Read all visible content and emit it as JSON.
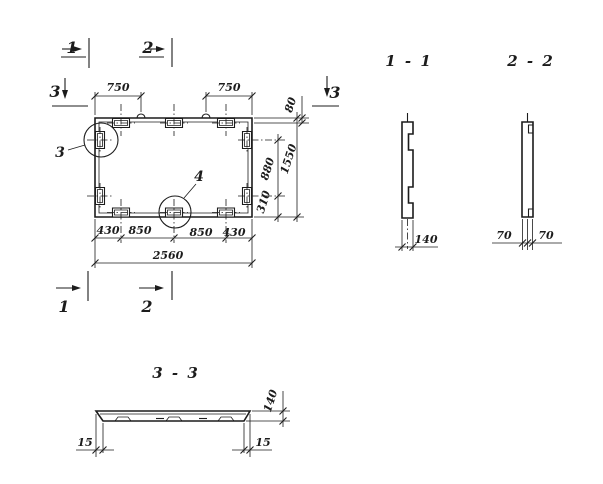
{
  "colors": {
    "ink": "#1c1c1c",
    "bg": "#ffffff"
  },
  "plan": {
    "marker_1": "1",
    "marker_2": "2",
    "marker_3": "3",
    "detail_3": "3",
    "detail_4": "4",
    "dim_top_left": "750",
    "dim_top_right": "750",
    "dim_right_offset": "80",
    "dim_right_upper": "880",
    "dim_right_lower": "310",
    "dim_right_total": "1550",
    "dim_bottom": [
      "430",
      "850",
      "850",
      "430"
    ],
    "dim_bottom_total": "2560"
  },
  "section_1_1": {
    "title": "1 - 1",
    "dim_thickness": "140"
  },
  "section_2_2": {
    "title": "2 - 2",
    "dim_left": "70",
    "dim_right": "70"
  },
  "section_3_3": {
    "title": "3 - 3",
    "dim_thickness": "140",
    "dim_left_lip": "15",
    "dim_right_lip": "15"
  }
}
